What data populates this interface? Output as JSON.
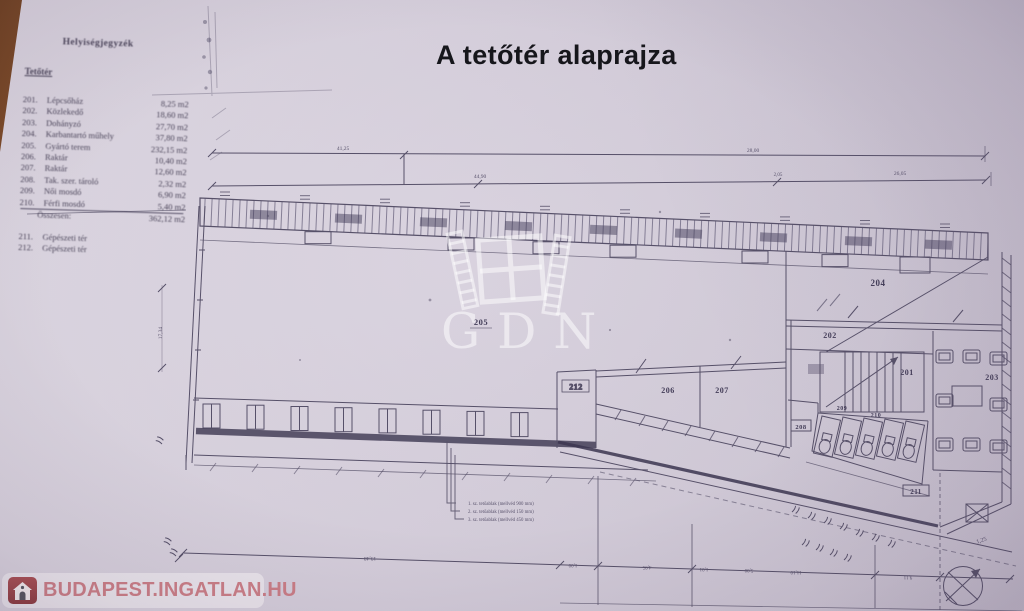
{
  "title": "A tetőtér alaprajza",
  "room_list": {
    "heading": "Helyiségjegyzék",
    "section": "Tetőtér",
    "rooms": [
      {
        "no": "201.",
        "name": "Lépcsőház",
        "area": "8,25 m2"
      },
      {
        "no": "202.",
        "name": "Közlekedő",
        "area": "18,60 m2"
      },
      {
        "no": "203.",
        "name": "Dohányzó",
        "area": "27,70 m2"
      },
      {
        "no": "204.",
        "name": "Karbantartó műhely",
        "area": "37,80 m2"
      },
      {
        "no": "205.",
        "name": "Gyártó terem",
        "area": "232,15 m2"
      },
      {
        "no": "206.",
        "name": "Raktár",
        "area": "10,40 m2"
      },
      {
        "no": "207.",
        "name": "Raktár",
        "area": "12,60 m2"
      },
      {
        "no": "208.",
        "name": "Tak. szer. tároló",
        "area": "2,32 m2"
      },
      {
        "no": "209.",
        "name": "Női mosdó",
        "area": "6,90 m2"
      },
      {
        "no": "210.",
        "name": "Férfi mosdó",
        "area": "5,40 m2"
      }
    ],
    "total_label": "Összesen:",
    "total_area": "362,12 m2",
    "extra_rooms": [
      {
        "no": "211.",
        "name": "Gépészeti tér"
      },
      {
        "no": "212.",
        "name": "Gépészeti tér"
      }
    ]
  },
  "plan": {
    "labels": {
      "r201": "201",
      "r202": "202",
      "r203": "203",
      "r204": "204",
      "r205": "205",
      "r206": "206",
      "r207": "207",
      "r208": "208",
      "r209": "209",
      "r210": "210",
      "r211": "211",
      "r212": "212"
    },
    "dims": {
      "top": [
        "41,25",
        "28,00"
      ],
      "upper": [
        "44,90",
        "2,05",
        "26,05"
      ],
      "left": "17,34",
      "bottom": [
        "19,48",
        "1,00",
        "4,95",
        "1,01",
        "5,00",
        "11,10",
        "9,11"
      ],
      "corner": "1,25"
    },
    "legend": [
      "1. sz. tetőablak (mellvéd 900 mm)",
      "2. sz. tetőablak (mellvéd 150 mm)",
      "3. sz. tetőablak (mellvéd 450 mm)"
    ]
  },
  "watermarks": {
    "gdn": "GDN",
    "footer": "BUDAPEST.INGATLAN.HU"
  },
  "colors": {
    "background": "#7c4a28",
    "paper": "#d3ccd9",
    "ink": "#4f4962",
    "ink_heavy": "#353049",
    "title": "#16161b",
    "logo_red": "#a04a4f",
    "logo_text": "#c97881",
    "watermark": "rgba(255,255,255,0.52)"
  }
}
